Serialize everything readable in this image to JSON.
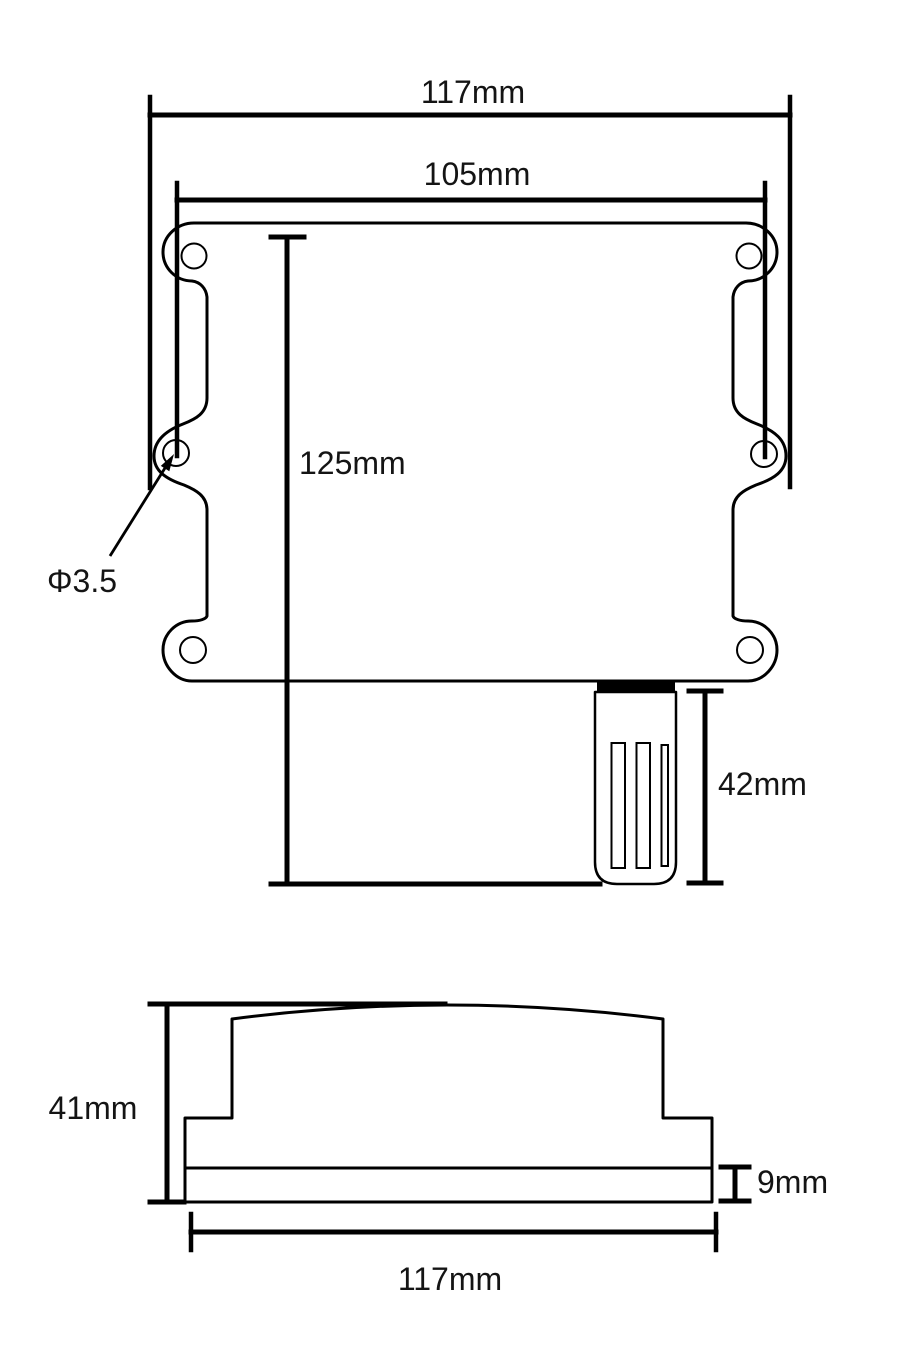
{
  "front_view": {
    "labels": {
      "overall_width": "117mm",
      "hole_spacing": "105mm",
      "body_height": "125mm",
      "hole_diameter": "Φ3.5",
      "probe_length": "42mm"
    }
  },
  "side_view": {
    "labels": {
      "height": "41mm",
      "base_thickness": "9mm",
      "width": "117mm"
    }
  },
  "colors": {
    "line": "#000000",
    "text": "#141414",
    "background": "#ffffff"
  }
}
